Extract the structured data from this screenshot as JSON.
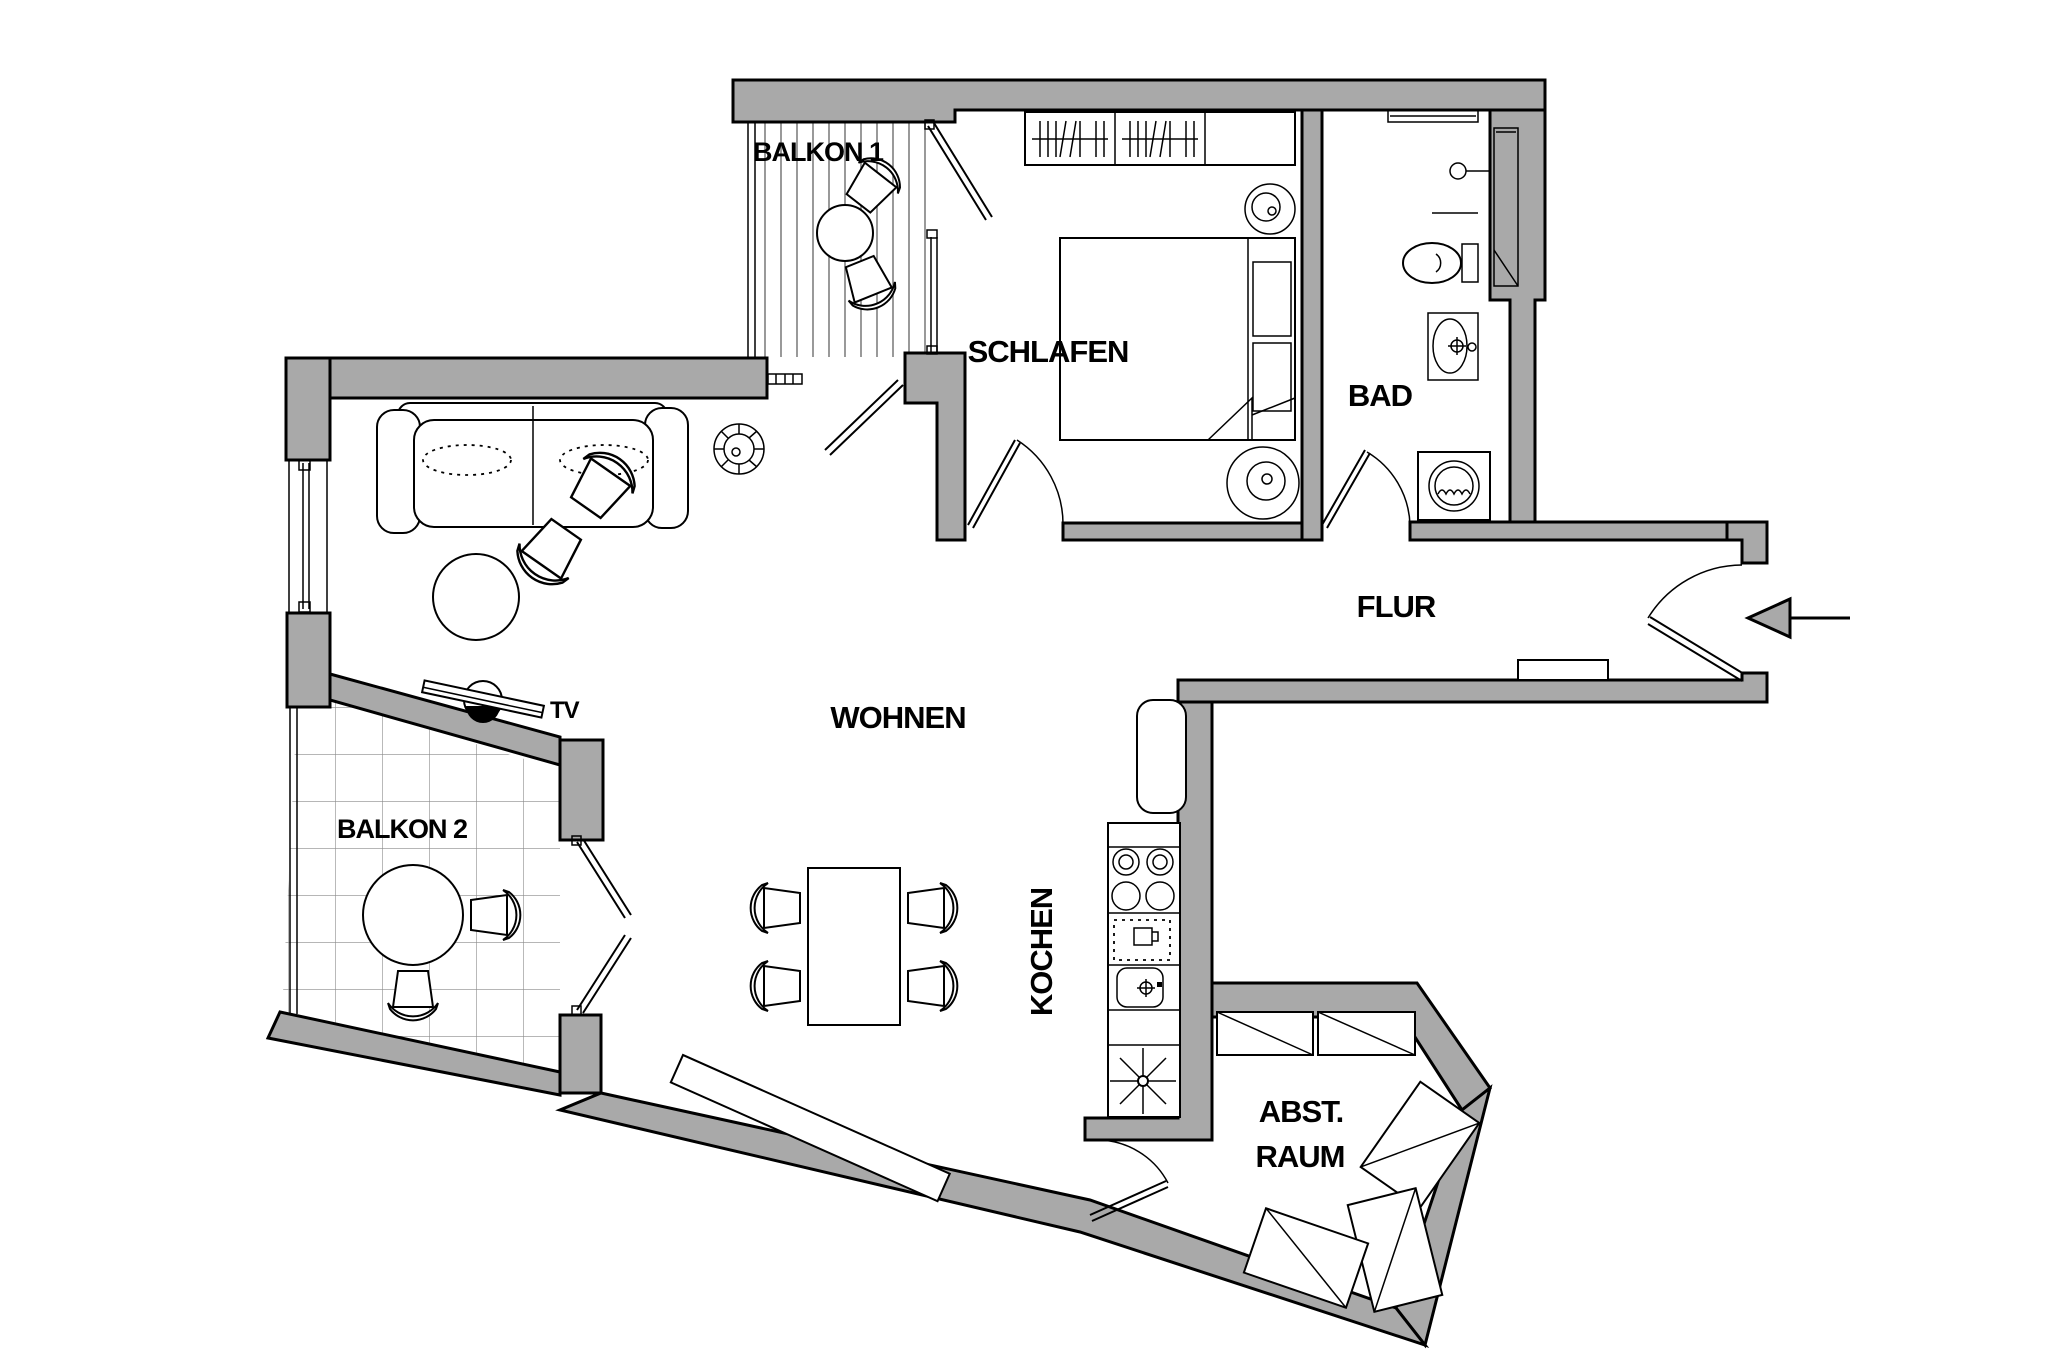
{
  "title": "Wohnungsgrundriss",
  "colors": {
    "wall_fill": "#a9a9a9",
    "outline": "#000000",
    "background": "#ffffff",
    "deck_line": "#6e6e6e",
    "tile_line": "#8a8a8a",
    "arrow_fill": "#a9a9a9"
  },
  "rooms": {
    "balkon1": {
      "label": "BALKON 1"
    },
    "schlafen": {
      "label": "SCHLAFEN"
    },
    "bad": {
      "label": "BAD"
    },
    "flur": {
      "label": "FLUR"
    },
    "wohnen": {
      "label": "WOHNEN"
    },
    "kochen": {
      "label": "KOCHEN"
    },
    "balkon2": {
      "label": "BALKON 2"
    },
    "abstellraum": {
      "line1": "ABST.",
      "line2": "RAUM"
    }
  },
  "annotations": {
    "tv": {
      "label": "TV"
    },
    "entrance": {
      "direction": "left"
    }
  }
}
